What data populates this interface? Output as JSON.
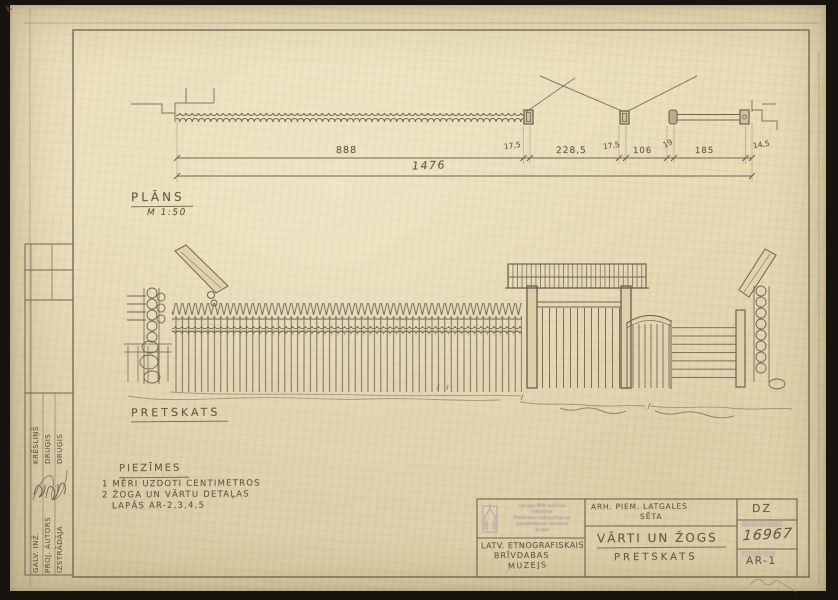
{
  "plan": {
    "label": "PLĀNS",
    "scale": "M 1:50"
  },
  "elevation": {
    "label": "PRETSKATS"
  },
  "dimensions": {
    "segments": [
      "888",
      "17,5",
      "228,5",
      "17,5",
      "106",
      "19",
      "185",
      "14,5"
    ],
    "total": "1476"
  },
  "notes": {
    "title": "PIEZĪMES",
    "line1": "1 MĒRI UZDOTI CENTIMETROS",
    "line2": "2 ŽOGA UN VĀRTU DETAĻAS",
    "line3": "LAPĀS AR-2,3,4,5"
  },
  "title_block": {
    "stamp_lines": [
      "Latvijas PSR kultūras",
      "ministrija",
      "Zinātniski restaurēšanas",
      "projektēšanas kantoris",
      "grupa"
    ],
    "organization_line1": "LATV. ETNOGRAFISKAIS",
    "organization_line2": "BRĪVDABAS",
    "organization_line3": "MUZEJS",
    "project_line1": "ARH. PIEM. LATGALES",
    "project_line2": "SĒTA",
    "sheet_title": "VĀRTI UN ŽOGS",
    "sheet_subtitle": "PRETSKATS",
    "series": "DZ",
    "inventory_number": "16967",
    "sheet_number": "AR-1"
  },
  "signatures": {
    "rows": [
      {
        "role": "GALV. INŽ.",
        "name": "KRĒSLIŅŠ"
      },
      {
        "role": "PROJ. AUTORS",
        "name": "DRUĢIS"
      },
      {
        "role": "IZSTRĀDĀJA",
        "name": "DRUĢIS"
      }
    ]
  },
  "colors": {
    "paper": "#e9ddb8",
    "pencil": "#6f6454",
    "stamp": "#8f85ad"
  }
}
